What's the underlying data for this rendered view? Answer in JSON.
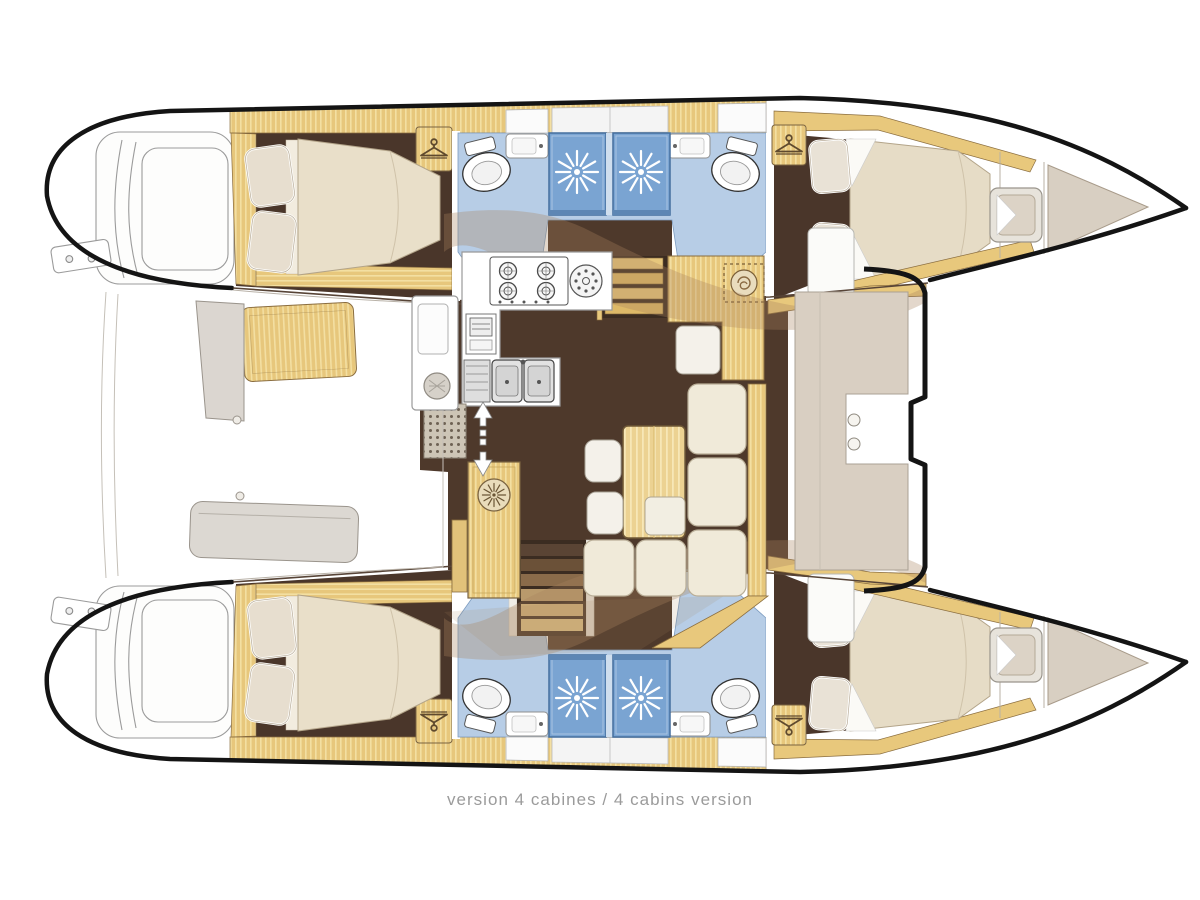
{
  "caption": "version 4 cabines / 4 cabins version",
  "plan": {
    "vessel": "catamaran",
    "view": "top-down interior deck plan",
    "layout_label": "4 cabins version",
    "orientation": {
      "bow": "right",
      "stern": "left"
    },
    "hulls": [
      {
        "id": "upper-hull",
        "rooms": [
          "aft double cabin with wardrobe",
          "aft bathroom with toilet, sink and shower stall",
          "forward bathroom with toilet, sink and shower stall",
          "forward double cabin with wardrobe",
          "bow seat locker",
          "forepeak"
        ],
        "swim_platform": true
      },
      {
        "id": "lower-hull",
        "rooms": [
          "aft double cabin with wardrobe",
          "aft bathroom with toilet, sink and shower stall",
          "forward bathroom with toilet, sink and shower stall",
          "forward double cabin with wardrobe",
          "bow seat locker",
          "forepeak"
        ],
        "swim_platform": true
      }
    ],
    "bridge_deck": {
      "rooms": [
        "L-shaped galley with 4-burner stove, round burner, oven and double sink",
        "chart table with stool",
        "salon with L-shaped sofa, wood table and stools",
        "companionway stairs to each hull",
        "tall wood locker with porthole emblem",
        "entry floor mat"
      ]
    },
    "exterior": {
      "aft_cockpit": [
        "wood bench",
        "angled side bench",
        "counter with sink",
        "long stern bench"
      ],
      "forward_cockpit": [
        "C-shaped bench seat with two cup holders"
      ],
      "swim_platforms": 2
    },
    "fixture_counts": {
      "beds": 4,
      "wardrobes": 4,
      "toilets": 4,
      "shower_stalls": 4,
      "bathroom_sinks": 4
    },
    "colors": {
      "outline": "#141414",
      "wood": "#e7c77c",
      "wood_dark_trim": "#8a6d3f",
      "cabin_floor": "#4a362a",
      "bathroom_floor": "#b7cde6",
      "shower_stall": "#7aa4d2",
      "upholstery_cream": "#eFe9d8",
      "bench_gray": "#dcd8d2",
      "deck_beige": "#d9cfc2",
      "shadow_overlay": "#a9845c",
      "caption_text": "#9b9b9b"
    }
  }
}
